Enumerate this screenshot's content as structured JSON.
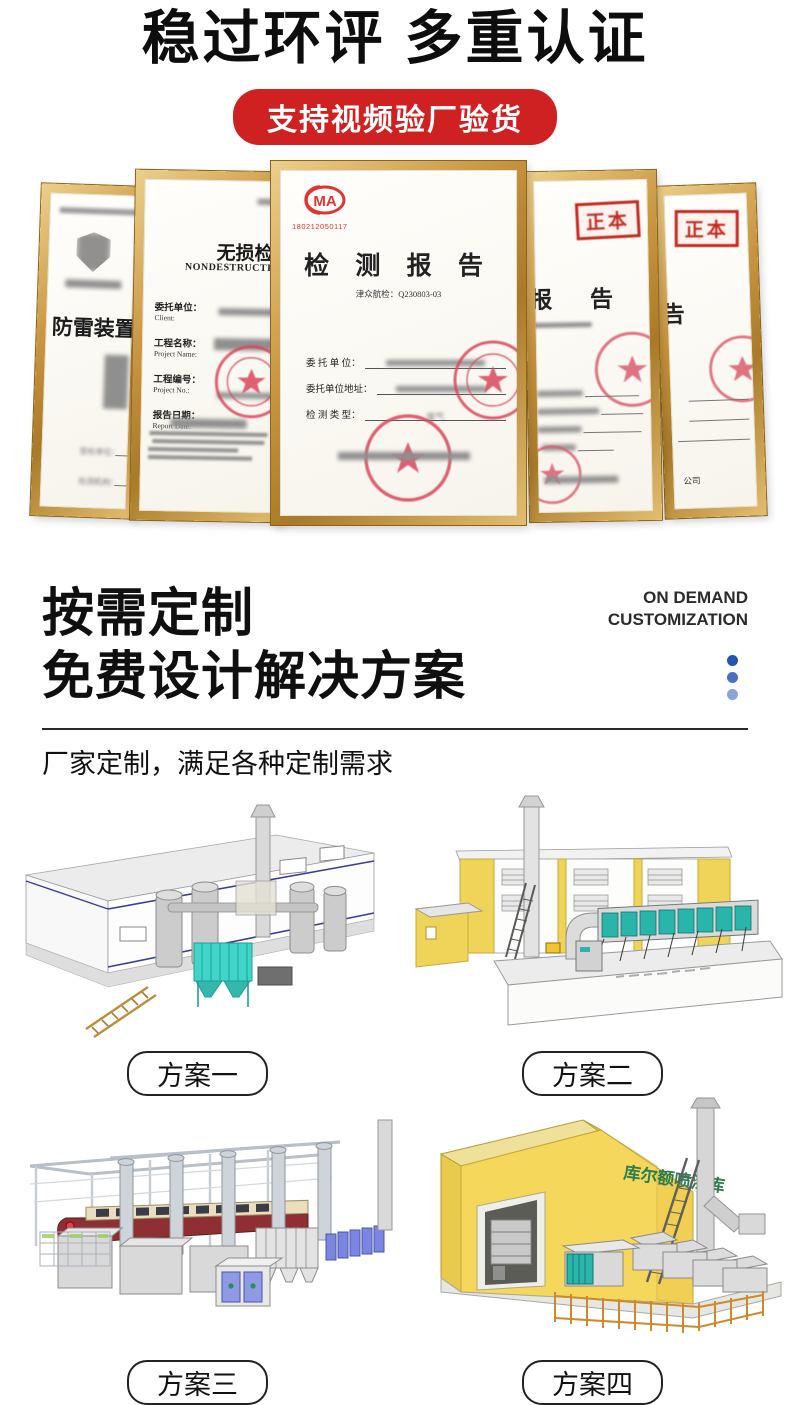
{
  "header": {
    "title": "稳过环评 多重认证",
    "badge": "支持视频验厂验货"
  },
  "certificates": {
    "cert1": {
      "title": "防雷装置",
      "bottom_label1": "受检单位：",
      "bottom_label2": "检测机构："
    },
    "cert2": {
      "title": "无损检测",
      "subtitle": "NONDESTRUCTIVE",
      "fields": [
        {
          "cn": "委托单位：",
          "en": "Client:"
        },
        {
          "cn": "工程名称：",
          "en": "Project Name:"
        },
        {
          "cn": "工程编号：",
          "en": "Project No.:"
        },
        {
          "cn": "报告日期：",
          "en": "Report Date:"
        }
      ]
    },
    "cert3": {
      "cma_text": "MA",
      "cma_number": "180212050117",
      "title": "检 测 报 告",
      "report_no": "津众航检：Q230803-03",
      "fields": [
        {
          "label": "委 托 单 位：",
          "value": ""
        },
        {
          "label": "委托单位地址：",
          "value": ""
        },
        {
          "label": "检 测 类 型：",
          "value": "废气"
        }
      ]
    },
    "cert4": {
      "stamp": "正本",
      "title": "报 告"
    },
    "cert5": {
      "stamp": "正本",
      "title": "告",
      "company_suffix": "公司"
    }
  },
  "customization": {
    "title_line1": "按需定制",
    "title_line2": "免费设计解决方案",
    "subtitle_en_line1": "ON DEMAND",
    "subtitle_en_line2": "CUSTOMIZATION",
    "description": "厂家定制，满足各种定制需求"
  },
  "plans": {
    "items": [
      {
        "label": "方案一"
      },
      {
        "label": "方案二"
      },
      {
        "label": "方案三"
      },
      {
        "label": "方案四"
      }
    ],
    "plan4_building_text": "库尔额喷漆库"
  },
  "colors": {
    "accent_red": "#cf2121",
    "stamp_red": "#c22a22",
    "gold_frame": "#c8943f",
    "teal_equipment": "#2ab5ab",
    "dot_blue_dark": "#2553b0",
    "dot_blue_mid": "#4a6fc2",
    "dot_blue_light": "#8aa3da"
  }
}
